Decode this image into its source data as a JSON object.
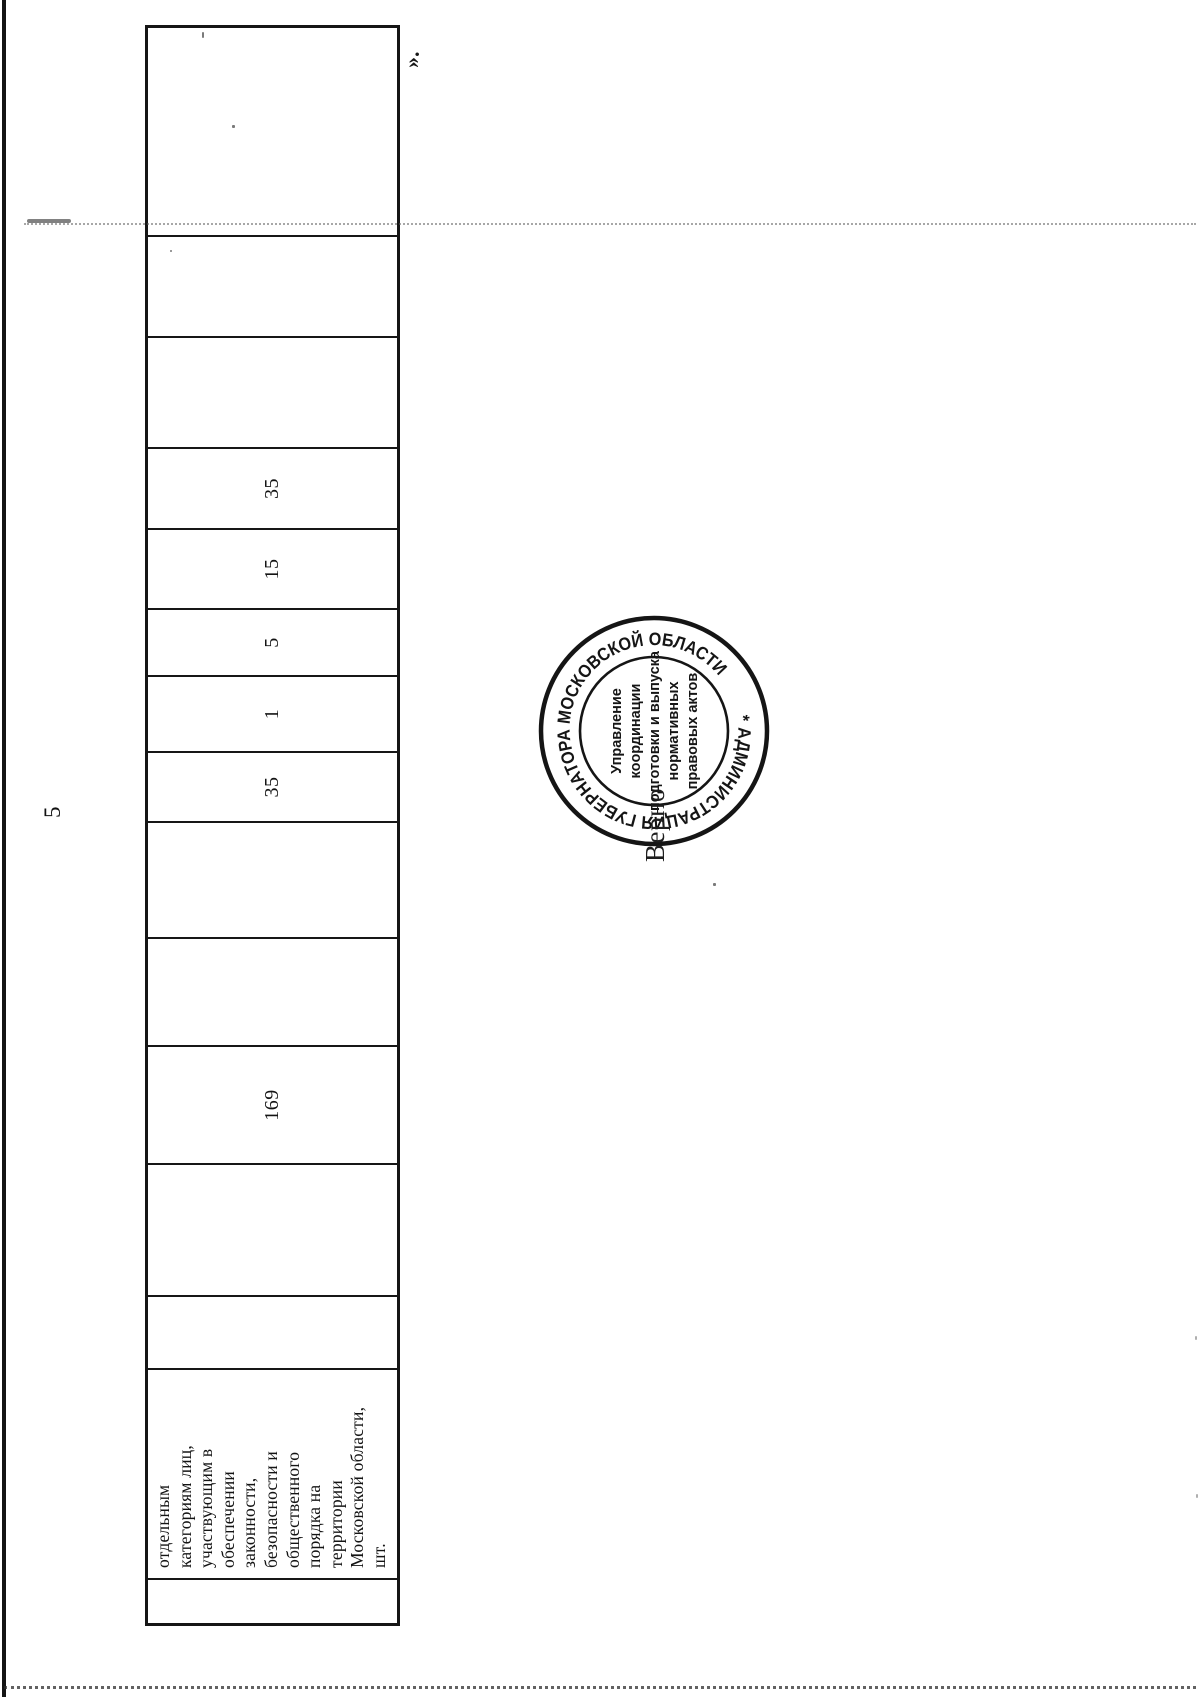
{
  "page": {
    "number": "5",
    "closing_quote": "»."
  },
  "table": {
    "columns": [
      {
        "value": ""
      },
      {
        "value": "отдельным\nкатегориям лиц,\nучаствующим в\nобеспечении\nзаконности,\nбезопасности и\nобщественного\nпорядка на\nтерритории\nМосковской области,\nшт."
      },
      {
        "value": ""
      },
      {
        "value": ""
      },
      {
        "value": "169"
      },
      {
        "value": ""
      },
      {
        "value": ""
      },
      {
        "value": "35"
      },
      {
        "value": "1"
      },
      {
        "value": "5"
      },
      {
        "value": "15"
      },
      {
        "value": "35"
      },
      {
        "value": ""
      },
      {
        "value": ""
      },
      {
        "value": ""
      }
    ]
  },
  "stamp": {
    "ring_text": "* АДМИНИСТРАЦИЯ ГУБЕРНАТОРА МОСКОВСКОЙ ОБЛАСТИ",
    "inner_lines": [
      "Управление",
      "координации",
      "подготовки и выпуска",
      "нормативных",
      "правовых актов"
    ]
  },
  "certification": {
    "label": "Верно"
  },
  "colors": {
    "ink": "#1b1b1b",
    "paper": "#ffffff"
  }
}
